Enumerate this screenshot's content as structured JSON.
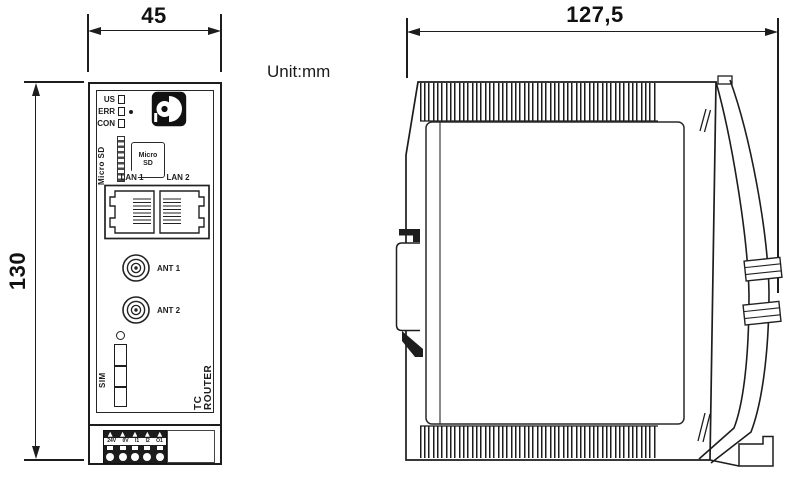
{
  "unit_label": "Unit:mm",
  "dimensions": {
    "front_width_mm": "45",
    "front_height_mm": "130",
    "side_depth_mm": "127,5"
  },
  "front_view": {
    "led_labels": [
      "US",
      "ERR",
      "CON"
    ],
    "micro_sd": {
      "slot_label": "Micro SD",
      "card_label_line1": "Micro",
      "card_label_line2": "SD"
    },
    "lan_labels": [
      "LAN 1",
      "LAN 2"
    ],
    "antenna_labels": [
      "ANT 1",
      "ANT 2"
    ],
    "sim_label": "SIM",
    "product_label": "TC ROUTER",
    "terminal_labels": [
      "24V",
      "0V",
      "I1",
      "I2",
      "O1"
    ]
  },
  "icons": {
    "brand_logo": "phoenix-contact-logo",
    "micro_sd_card": "micro-sd-card-icon",
    "lan_port": "rj45-jack-icon",
    "antenna_connector": "coax-antenna-connector-icon",
    "sim_slot": "sim-card-slot-icon",
    "terminal_block": "screw-terminal-block-icon",
    "din_rail": "din-rail-mount-icon"
  },
  "colors": {
    "line": "#1d1d1d",
    "background": "#ffffff"
  }
}
